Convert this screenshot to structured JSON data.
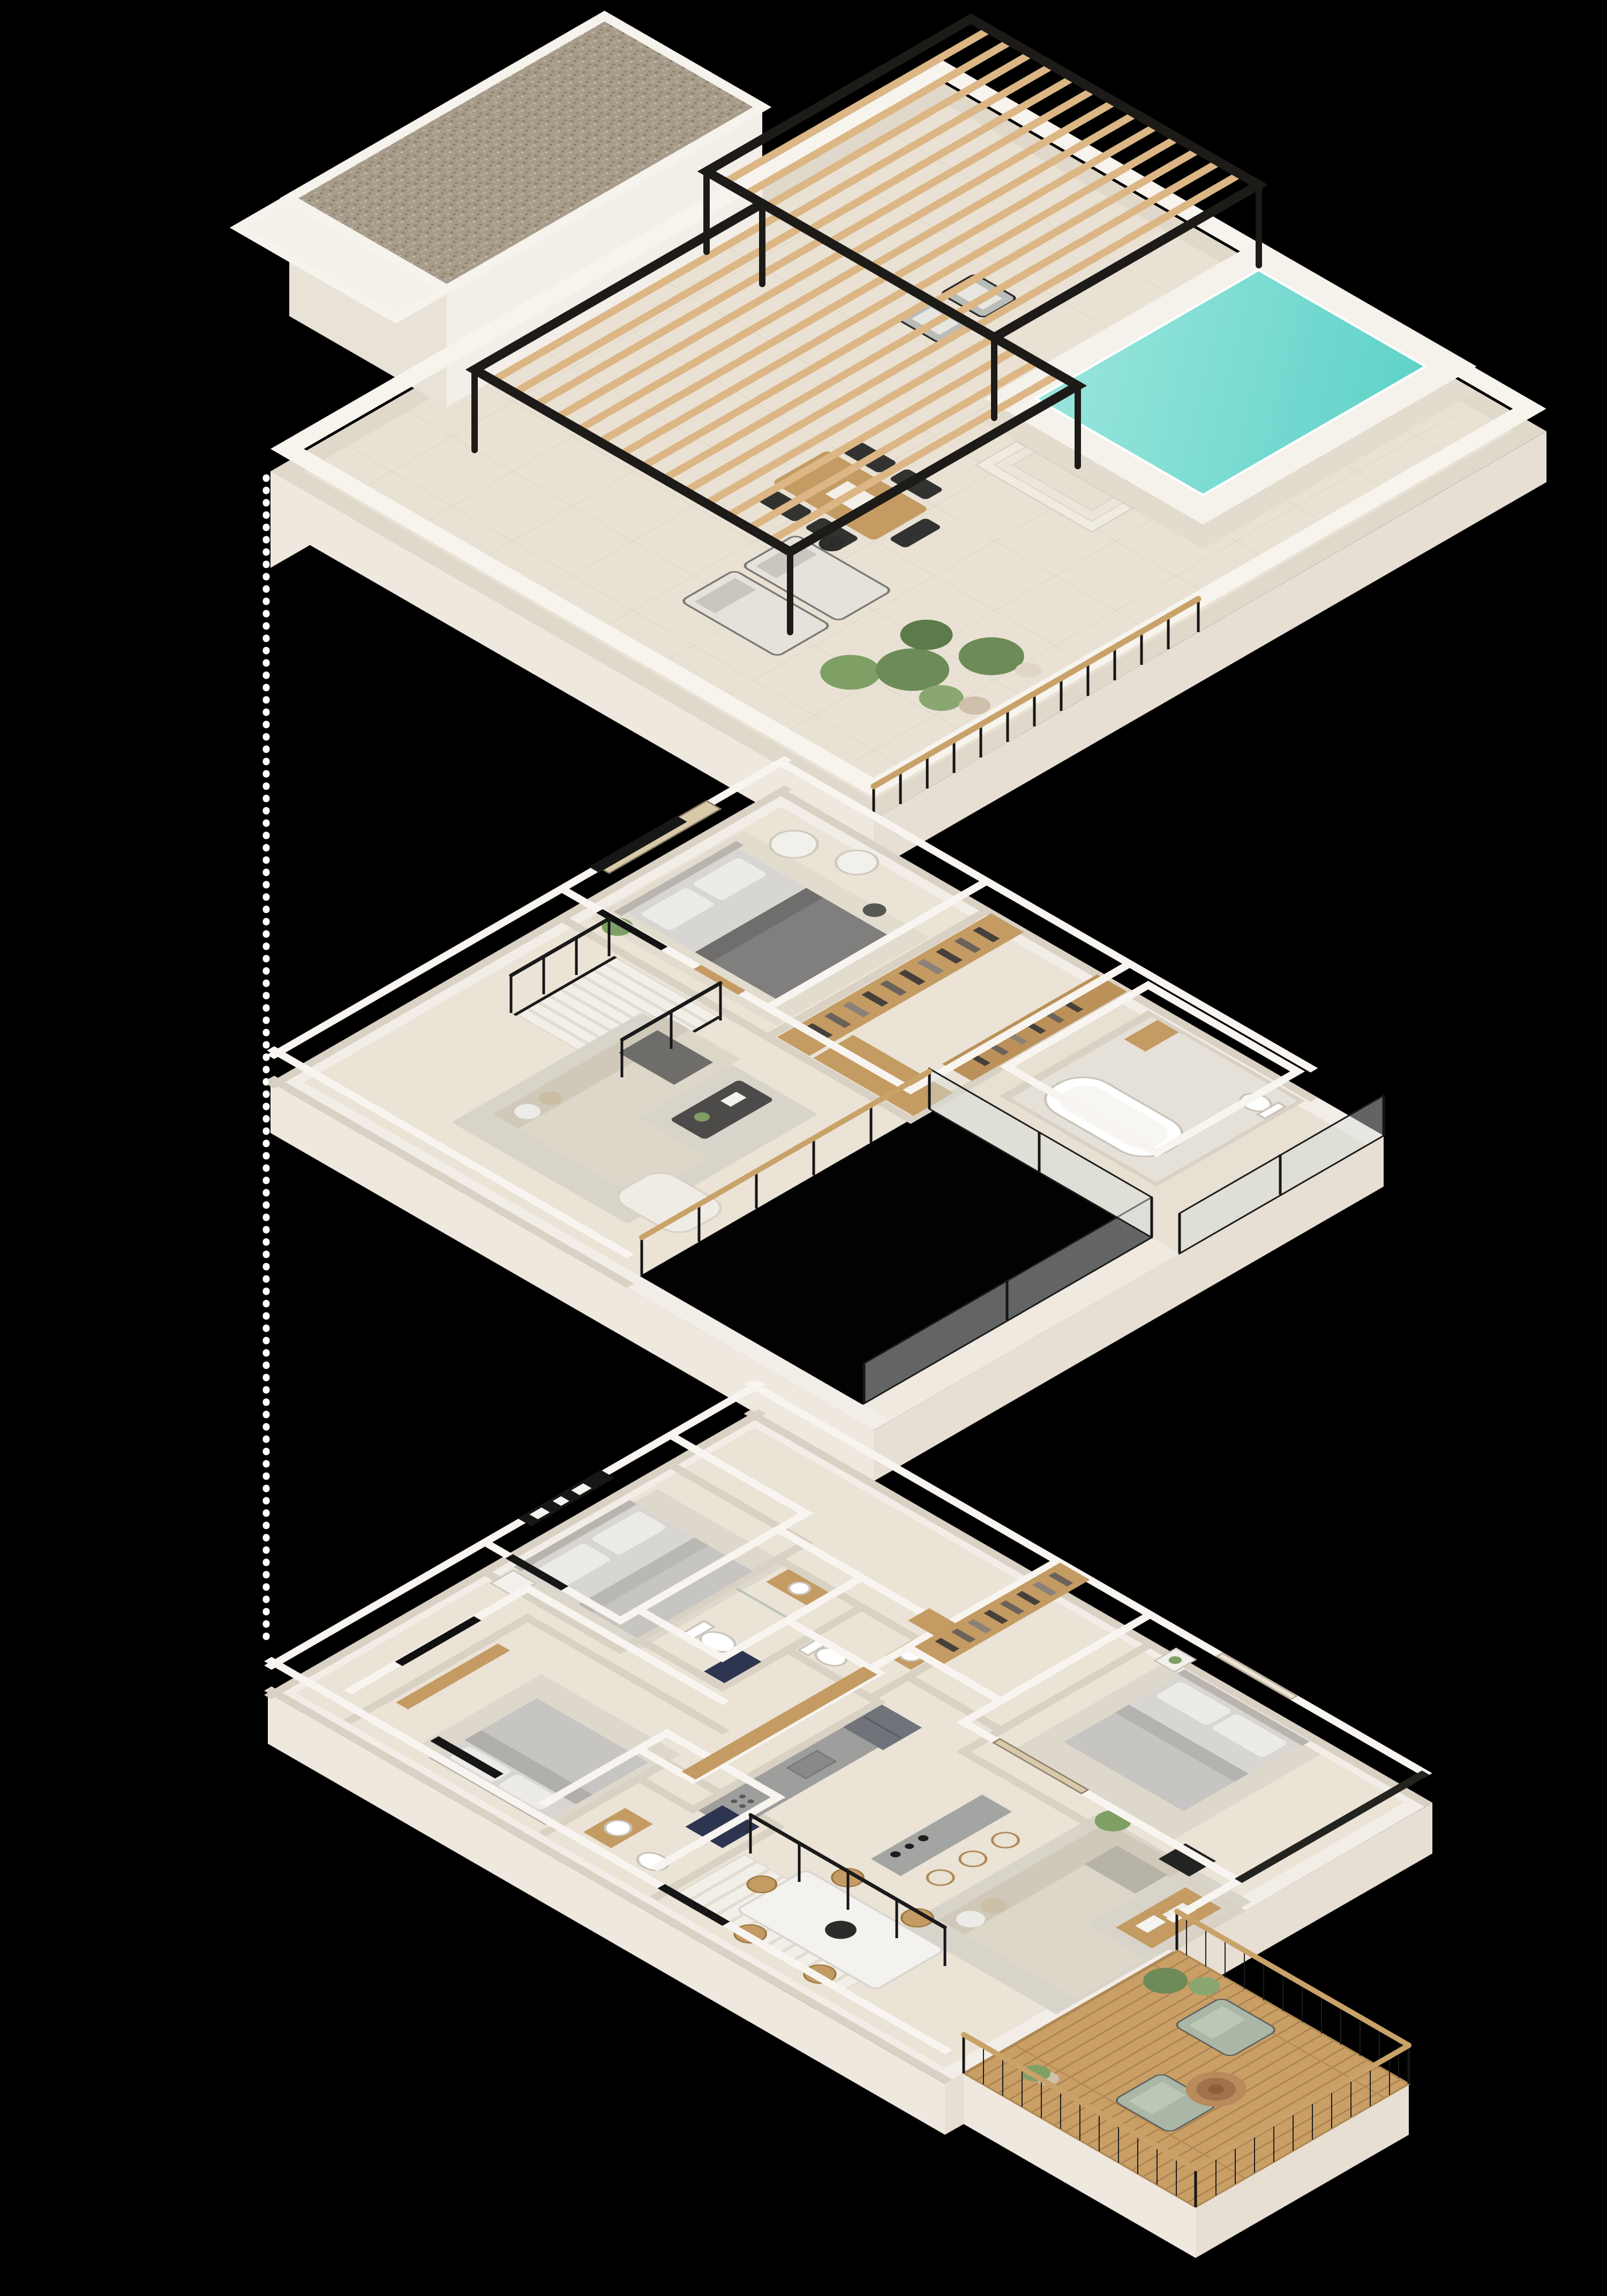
{
  "meta": {
    "title": "Exploded isometric 3D floor plan of a three-storey villa",
    "view": "axonometric top-down render on black background"
  },
  "colors": {
    "background": "#000000",
    "slab_top": "#f2eee7",
    "slab_side": "#efe8df",
    "floor": "#eae3d6",
    "terrace_floor": "#e9e2d4",
    "wall_top": "#f8f5f0",
    "wall_side": "#d9d1c4",
    "gravel": "#a79b8a",
    "pergola_frame": "#1d1b18",
    "pergola_slat": "#dcb684",
    "pool_water": "#5fd2c8",
    "pool_water_light": "#9ae6dd",
    "plant": "#7fa065",
    "plant_dark": "#5d7b4a",
    "plant_light": "#8aa772",
    "pot": "#cfc0ab",
    "wood": "#c49b63",
    "wood_dark": "#a97f4e",
    "deck": "#c99f66",
    "deck_gap": "#ab8151",
    "rail_black": "#161616",
    "handrail_wood": "#c9a269",
    "glass": "#d7dedc",
    "bed_duvet_dark": "#807f7d",
    "sofa_beige": "#ddd7c9",
    "marble": "#f4f2ee",
    "tub_white": "#ffffff",
    "counter_gray": "#9e9e9c",
    "fridge_gray": "#70737a",
    "sage_chair": "#aab7a7",
    "navy_mat": "#2e3550",
    "art_dark": "#171717",
    "art_tan": "#d8c9a8",
    "tv_black": "#101010",
    "dotted_line": "#ffffff"
  },
  "floors": [
    {
      "id": "rooftop",
      "label": "Rooftop terrace",
      "features": [
        "gravel-roof",
        "slatted-pergola",
        "plunge-pool",
        "pool-steps",
        "sun-loungers",
        "outdoor-dining-set",
        "planters",
        "wood-rail"
      ]
    },
    {
      "id": "upper",
      "label": "Upper floor",
      "features": [
        "bedroom",
        "walk-in-closet",
        "bathroom-with-tub",
        "living-lounge",
        "staircase",
        "double-height-void",
        "glass-balustrade"
      ]
    },
    {
      "id": "ground",
      "label": "Ground floor",
      "features": [
        "bedroom-1",
        "bedroom-2",
        "master-bedroom",
        "two-bathrooms",
        "kitchen",
        "island-bar",
        "dining-area",
        "living-area",
        "staircase",
        "wood-deck-terrace"
      ]
    }
  ],
  "connector": {
    "type": "dotted-vertical-line"
  }
}
